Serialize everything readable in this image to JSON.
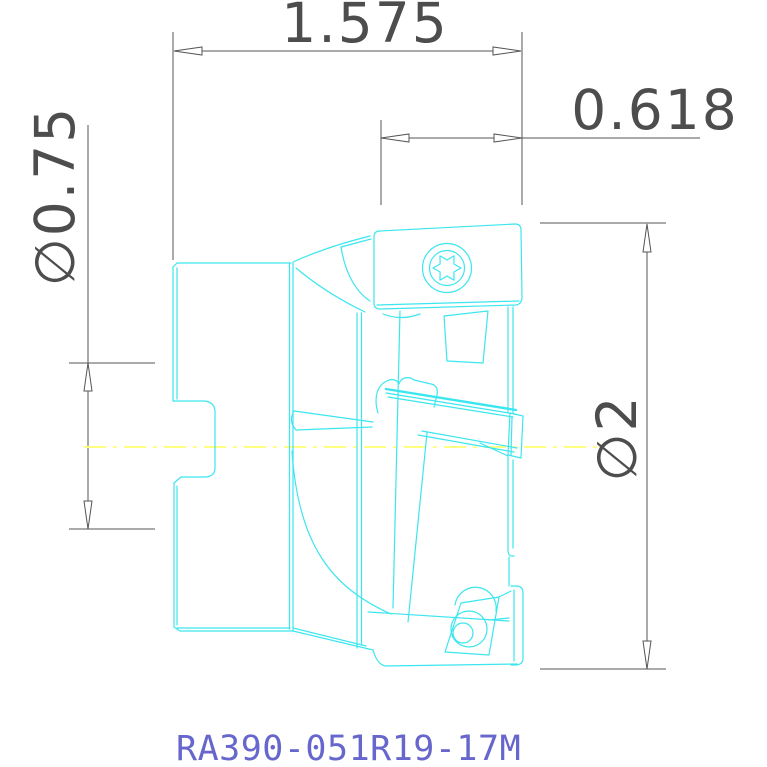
{
  "drawing": {
    "part_number": "RA390-051R19-17M",
    "view": "side-view-milling-cutter",
    "dimensions": [
      {
        "id": "overall-length",
        "label": "1.575"
      },
      {
        "id": "head-length",
        "label": "0.618"
      },
      {
        "id": "shank-diameter",
        "label": "∅0.75"
      },
      {
        "id": "cutting-diameter",
        "label": "∅2"
      }
    ],
    "colors": {
      "geometry": "#3ce6ef",
      "dimension_lines": "#4d4d4d",
      "centerline": "#ffff8c",
      "part_number_text": "#6666cc",
      "background": "#ffffff"
    }
  }
}
